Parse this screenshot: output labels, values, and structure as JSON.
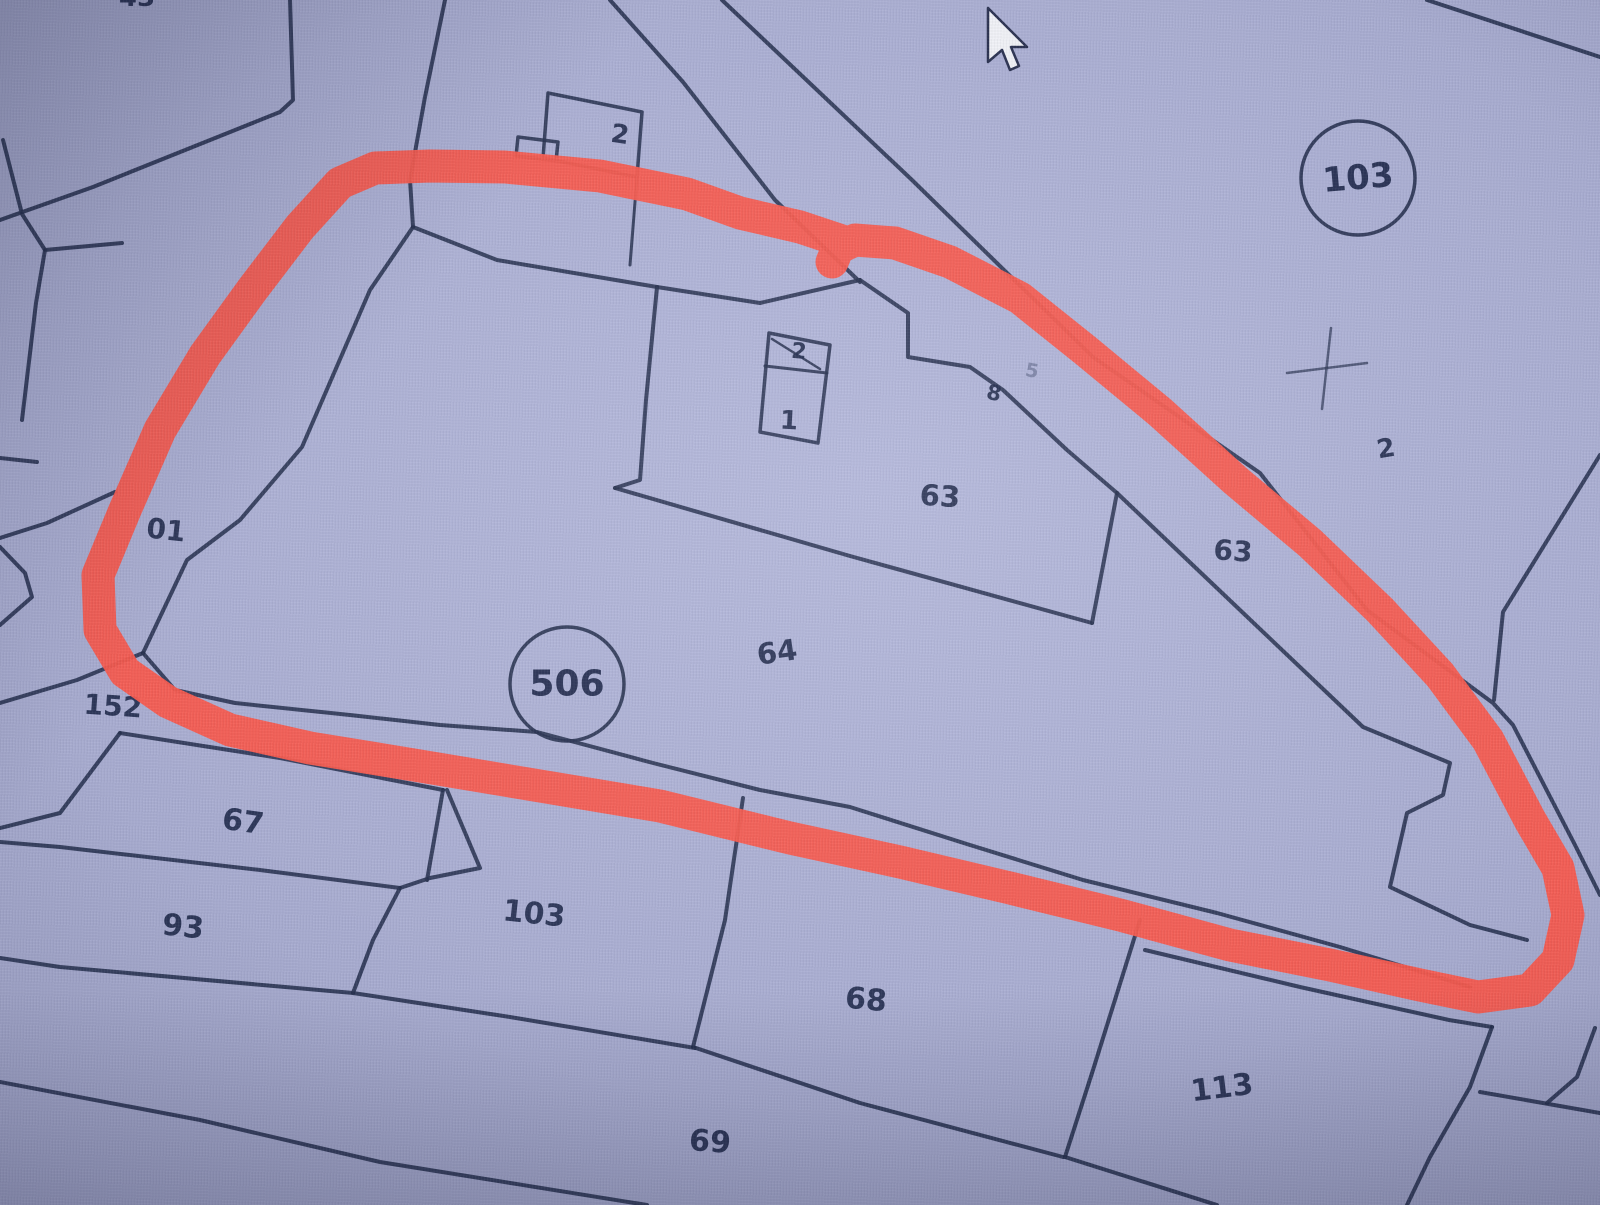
{
  "map": {
    "ink_color": "#26304f",
    "text_color": "#222c4e",
    "highlight_color": "#f85a4e",
    "highlight_width": 33,
    "background_color": "#aaaed2",
    "labels": [
      {
        "name": "parcel-label-43-clipped",
        "text": "43",
        "x": 137,
        "y": -2,
        "size": 26,
        "rot": 0
      },
      {
        "name": "building-label-2-top",
        "text": "2",
        "x": 620,
        "y": 135,
        "size": 26,
        "rot": 8
      },
      {
        "name": "parcel-label-2-right",
        "text": "2",
        "x": 1386,
        "y": 449,
        "size": 26,
        "rot": -10
      },
      {
        "name": "building-label-2-center",
        "text": "2",
        "x": 799,
        "y": 352,
        "size": 22,
        "rot": 5
      },
      {
        "name": "building-label-1-center",
        "text": "1",
        "x": 789,
        "y": 421,
        "size": 26,
        "rot": 3
      },
      {
        "name": "parcel-label-63",
        "text": "63",
        "x": 940,
        "y": 496,
        "size": 29,
        "rot": 4
      },
      {
        "name": "parcel-label-63-road",
        "text": "63",
        "x": 1233,
        "y": 551,
        "size": 28,
        "rot": 4
      },
      {
        "name": "small-label-8",
        "text": "8",
        "x": 994,
        "y": 393,
        "size": 21,
        "rot": 12
      },
      {
        "name": "small-label-5-faint",
        "text": "5",
        "x": 1032,
        "y": 371,
        "size": 19,
        "rot": 10,
        "opacity": 0.35
      },
      {
        "name": "parcel-label-64",
        "text": "64",
        "x": 777,
        "y": 652,
        "size": 29,
        "rot": -8
      },
      {
        "name": "parcel-label-67",
        "text": "67",
        "x": 243,
        "y": 822,
        "size": 30,
        "rot": 8
      },
      {
        "name": "parcel-label-93",
        "text": "93",
        "x": 183,
        "y": 927,
        "size": 30,
        "rot": 6
      },
      {
        "name": "parcel-label-103-bottom",
        "text": "103",
        "x": 534,
        "y": 914,
        "size": 30,
        "rot": 6
      },
      {
        "name": "parcel-label-68",
        "text": "68",
        "x": 866,
        "y": 1000,
        "size": 30,
        "rot": 5
      },
      {
        "name": "parcel-label-69",
        "text": "69",
        "x": 710,
        "y": 1142,
        "size": 30,
        "rot": 4
      },
      {
        "name": "parcel-label-113",
        "text": "113",
        "x": 1222,
        "y": 1088,
        "size": 30,
        "rot": -7
      },
      {
        "name": "parcel-label-152",
        "text": "152",
        "x": 113,
        "y": 706,
        "size": 28,
        "rot": 4
      },
      {
        "name": "parcel-label-01",
        "text": "01",
        "x": 166,
        "y": 530,
        "size": 28,
        "rot": 6
      }
    ],
    "circled_labels": [
      {
        "name": "circled-parcel-103",
        "text": "103",
        "x": 1358,
        "y": 178,
        "r": 57,
        "size": 34,
        "rot": -5
      },
      {
        "name": "circled-parcel-506",
        "text": "506",
        "x": 567,
        "y": 684,
        "r": 57,
        "size": 36,
        "rot": 0
      }
    ],
    "lines": [
      {
        "id": "topleft-strip-outer",
        "pts": [
          [
            290,
            0
          ],
          [
            293,
            100
          ],
          [
            280,
            112
          ],
          [
            93,
            187
          ],
          [
            0,
            220
          ]
        ]
      },
      {
        "id": "topleft-strip-inner",
        "pts": [
          [
            3,
            140
          ],
          [
            22,
            214
          ],
          [
            45,
            250
          ],
          [
            36,
            303
          ],
          [
            22,
            420
          ]
        ]
      },
      {
        "id": "topleft-spur",
        "pts": [
          [
            45,
            250
          ],
          [
            122,
            243
          ]
        ]
      },
      {
        "id": "left-edge-stub",
        "pts": [
          [
            0,
            458
          ],
          [
            37,
            462
          ]
        ]
      },
      {
        "id": "left-small-parcel-a",
        "pts": [
          [
            115,
            492
          ],
          [
            47,
            523
          ],
          [
            0,
            538
          ]
        ]
      },
      {
        "id": "left-small-parcel-b",
        "pts": [
          [
            0,
            547
          ],
          [
            25,
            573
          ],
          [
            32,
            597
          ],
          [
            0,
            625
          ]
        ]
      },
      {
        "id": "parcel152-top",
        "pts": [
          [
            0,
            703
          ],
          [
            77,
            680
          ],
          [
            143,
            653
          ]
        ]
      },
      {
        "id": "road-upper-left-edge",
        "pts": [
          [
            445,
            0
          ],
          [
            425,
            97
          ],
          [
            410,
            180
          ],
          [
            413,
            227
          ]
        ]
      },
      {
        "id": "parcel64-left",
        "pts": [
          [
            413,
            227
          ],
          [
            370,
            290
          ],
          [
            302,
            447
          ],
          [
            240,
            520
          ],
          [
            187,
            560
          ],
          [
            143,
            653
          ]
        ]
      },
      {
        "id": "parcel64-top",
        "pts": [
          [
            413,
            227
          ],
          [
            497,
            260
          ],
          [
            657,
            287
          ]
        ]
      },
      {
        "id": "parcel64-bottom",
        "pts": [
          [
            143,
            653
          ],
          [
            175,
            690
          ],
          [
            235,
            703
          ],
          [
            350,
            715
          ],
          [
            440,
            725
          ],
          [
            537,
            732
          ],
          [
            653,
            763
          ],
          [
            760,
            790
          ],
          [
            850,
            807
          ],
          [
            970,
            845
          ],
          [
            1083,
            880
          ],
          [
            1217,
            913
          ],
          [
            1340,
            947
          ],
          [
            1470,
            987
          ]
        ]
      },
      {
        "id": "parcel64-right",
        "pts": [
          [
            1117,
            493
          ],
          [
            1240,
            610
          ],
          [
            1363,
            727
          ],
          [
            1450,
            763
          ],
          [
            1443,
            795
          ],
          [
            1407,
            813
          ],
          [
            1390,
            887
          ],
          [
            1470,
            925
          ],
          [
            1527,
            940
          ]
        ]
      },
      {
        "id": "parcel63-left",
        "pts": [
          [
            657,
            287
          ],
          [
            646,
            400
          ],
          [
            640,
            480
          ],
          [
            615,
            488
          ]
        ]
      },
      {
        "id": "parcel63-top",
        "pts": [
          [
            657,
            287
          ],
          [
            760,
            303
          ],
          [
            860,
            280
          ]
        ]
      },
      {
        "id": "parcel63-notch",
        "pts": [
          [
            860,
            280
          ],
          [
            908,
            313
          ],
          [
            908,
            357
          ],
          [
            970,
            367
          ],
          [
            1003,
            390
          ],
          [
            1067,
            450
          ],
          [
            1117,
            493
          ]
        ]
      },
      {
        "id": "parcel63-bottom",
        "pts": [
          [
            615,
            488
          ],
          [
            850,
            556
          ],
          [
            1092,
            623
          ]
        ]
      },
      {
        "id": "parcel63-right",
        "pts": [
          [
            1117,
            493
          ],
          [
            1092,
            623
          ]
        ]
      },
      {
        "id": "road-r1",
        "pts": [
          [
            610,
            0
          ],
          [
            683,
            82
          ],
          [
            775,
            200
          ],
          [
            860,
            282
          ]
        ]
      },
      {
        "id": "road-r2",
        "pts": [
          [
            722,
            0
          ],
          [
            912,
            180
          ],
          [
            1093,
            357
          ],
          [
            1260,
            473
          ],
          [
            1367,
            610
          ],
          [
            1493,
            703
          ],
          [
            1513,
            725
          ],
          [
            1575,
            845
          ],
          [
            1600,
            895
          ]
        ]
      },
      {
        "id": "road-r3",
        "pts": [
          [
            1427,
            0
          ],
          [
            1600,
            57
          ]
        ]
      },
      {
        "id": "road-r4",
        "pts": [
          [
            1600,
            455
          ],
          [
            1503,
            612
          ],
          [
            1494,
            700
          ]
        ]
      },
      {
        "id": "parcel67-top",
        "pts": [
          [
            120,
            733
          ],
          [
            280,
            758
          ],
          [
            443,
            790
          ]
        ]
      },
      {
        "id": "parcel67-left",
        "pts": [
          [
            120,
            733
          ],
          [
            60,
            813
          ],
          [
            0,
            828
          ]
        ]
      },
      {
        "id": "parcel67-right",
        "pts": [
          [
            443,
            790
          ],
          [
            427,
            880
          ]
        ]
      },
      {
        "id": "parcel103-left-upper",
        "pts": [
          [
            447,
            790
          ],
          [
            480,
            868
          ],
          [
            430,
            878
          ],
          [
            400,
            888
          ]
        ]
      },
      {
        "id": "parcel93-top",
        "pts": [
          [
            0,
            842
          ],
          [
            60,
            847
          ],
          [
            260,
            870
          ],
          [
            400,
            888
          ]
        ]
      },
      {
        "id": "parcel93-right",
        "pts": [
          [
            400,
            888
          ],
          [
            373,
            940
          ],
          [
            353,
            993
          ]
        ]
      },
      {
        "id": "parcel69-top",
        "pts": [
          [
            0,
            958
          ],
          [
            60,
            967
          ],
          [
            353,
            993
          ],
          [
            510,
            1017
          ],
          [
            695,
            1048
          ]
        ]
      },
      {
        "id": "parcel68-left",
        "pts": [
          [
            743,
            798
          ],
          [
            725,
            920
          ],
          [
            693,
            1047
          ]
        ]
      },
      {
        "id": "parcel68-bottom",
        "pts": [
          [
            693,
            1047
          ],
          [
            860,
            1103
          ],
          [
            1063,
            1157
          ]
        ]
      },
      {
        "id": "parcel113-bottom",
        "pts": [
          [
            1065,
            1157
          ],
          [
            1217,
            1205
          ]
        ]
      },
      {
        "id": "parcel113-left",
        "pts": [
          [
            1140,
            920
          ],
          [
            1093,
            1070
          ],
          [
            1065,
            1157
          ]
        ]
      },
      {
        "id": "parcel113-top",
        "pts": [
          [
            1145,
            950
          ],
          [
            1300,
            987
          ],
          [
            1449,
            1020
          ],
          [
            1492,
            1027
          ]
        ]
      },
      {
        "id": "parcel113-right",
        "pts": [
          [
            1492,
            1027
          ],
          [
            1470,
            1087
          ],
          [
            1430,
            1157
          ],
          [
            1407,
            1205
          ]
        ]
      },
      {
        "id": "bottomright-spur",
        "pts": [
          [
            1480,
            1092
          ],
          [
            1600,
            1113
          ]
        ]
      },
      {
        "id": "bottomright-curve",
        "pts": [
          [
            1595,
            1028
          ],
          [
            1577,
            1077
          ],
          [
            1547,
            1103
          ]
        ]
      },
      {
        "id": "bottom-boundary",
        "pts": [
          [
            0,
            1082
          ],
          [
            200,
            1120
          ],
          [
            380,
            1162
          ],
          [
            647,
            1205
          ]
        ]
      },
      {
        "id": "building-top-connector",
        "pts": [
          [
            637,
            177
          ],
          [
            630,
            265
          ]
        ],
        "w": 3
      },
      {
        "id": "building-a-outline",
        "pts": [
          [
            548,
            93
          ],
          [
            642,
            112
          ],
          [
            637,
            177
          ],
          [
            543,
            158
          ],
          [
            548,
            93
          ]
        ],
        "w": 3.5
      },
      {
        "id": "building-a-porch",
        "pts": [
          [
            518,
            137
          ],
          [
            558,
            142
          ],
          [
            556,
            161
          ],
          [
            516,
            156
          ],
          [
            518,
            137
          ]
        ],
        "w": 3.5
      },
      {
        "id": "building-b-outline",
        "pts": [
          [
            769,
            333
          ],
          [
            830,
            345
          ],
          [
            818,
            443
          ],
          [
            760,
            432
          ],
          [
            769,
            333
          ]
        ],
        "w": 3.5
      },
      {
        "id": "building-b-divider",
        "pts": [
          [
            765,
            366
          ],
          [
            827,
            373
          ]
        ],
        "w": 3
      },
      {
        "id": "building-b-roof-line",
        "pts": [
          [
            772,
            339
          ],
          [
            820,
            369
          ]
        ],
        "w": 2.5
      },
      {
        "id": "survey-cross-h",
        "pts": [
          [
            1287,
            373
          ],
          [
            1367,
            363
          ]
        ],
        "w": 2.5,
        "o": 0.7
      },
      {
        "id": "survey-cross-v",
        "pts": [
          [
            1331,
            328
          ],
          [
            1322,
            409
          ]
        ],
        "w": 2.5,
        "o": 0.7
      }
    ],
    "annotation_points": [
      [
        848,
        243
      ],
      [
        800,
        227
      ],
      [
        740,
        213
      ],
      [
        687,
        194
      ],
      [
        600,
        176
      ],
      [
        505,
        167
      ],
      [
        430,
        166
      ],
      [
        375,
        168
      ],
      [
        340,
        183
      ],
      [
        300,
        227
      ],
      [
        252,
        290
      ],
      [
        205,
        355
      ],
      [
        160,
        430
      ],
      [
        125,
        510
      ],
      [
        98,
        575
      ],
      [
        100,
        630
      ],
      [
        125,
        672
      ],
      [
        168,
        702
      ],
      [
        230,
        730
      ],
      [
        310,
        748
      ],
      [
        420,
        766
      ],
      [
        540,
        786
      ],
      [
        660,
        806
      ],
      [
        790,
        838
      ],
      [
        900,
        862
      ],
      [
        1010,
        888
      ],
      [
        1120,
        915
      ],
      [
        1230,
        945
      ],
      [
        1330,
        965
      ],
      [
        1420,
        985
      ],
      [
        1478,
        997
      ],
      [
        1530,
        990
      ],
      [
        1558,
        960
      ],
      [
        1568,
        915
      ],
      [
        1558,
        868
      ],
      [
        1530,
        820
      ],
      [
        1488,
        740
      ],
      [
        1440,
        675
      ],
      [
        1380,
        610
      ],
      [
        1310,
        543
      ],
      [
        1235,
        480
      ],
      [
        1160,
        412
      ],
      [
        1085,
        350
      ],
      [
        1020,
        298
      ],
      [
        950,
        262
      ],
      [
        895,
        243
      ],
      [
        855,
        240
      ],
      [
        838,
        248
      ],
      [
        832,
        262
      ]
    ],
    "cursor": {
      "points": [
        [
          988,
          8
        ],
        [
          988,
          62
        ],
        [
          1002,
          50
        ],
        [
          1010,
          70
        ],
        [
          1019,
          66
        ],
        [
          1011,
          47
        ],
        [
          1027,
          47
        ]
      ],
      "fill": "#f1f2f7",
      "stroke": "#2a3150"
    }
  }
}
